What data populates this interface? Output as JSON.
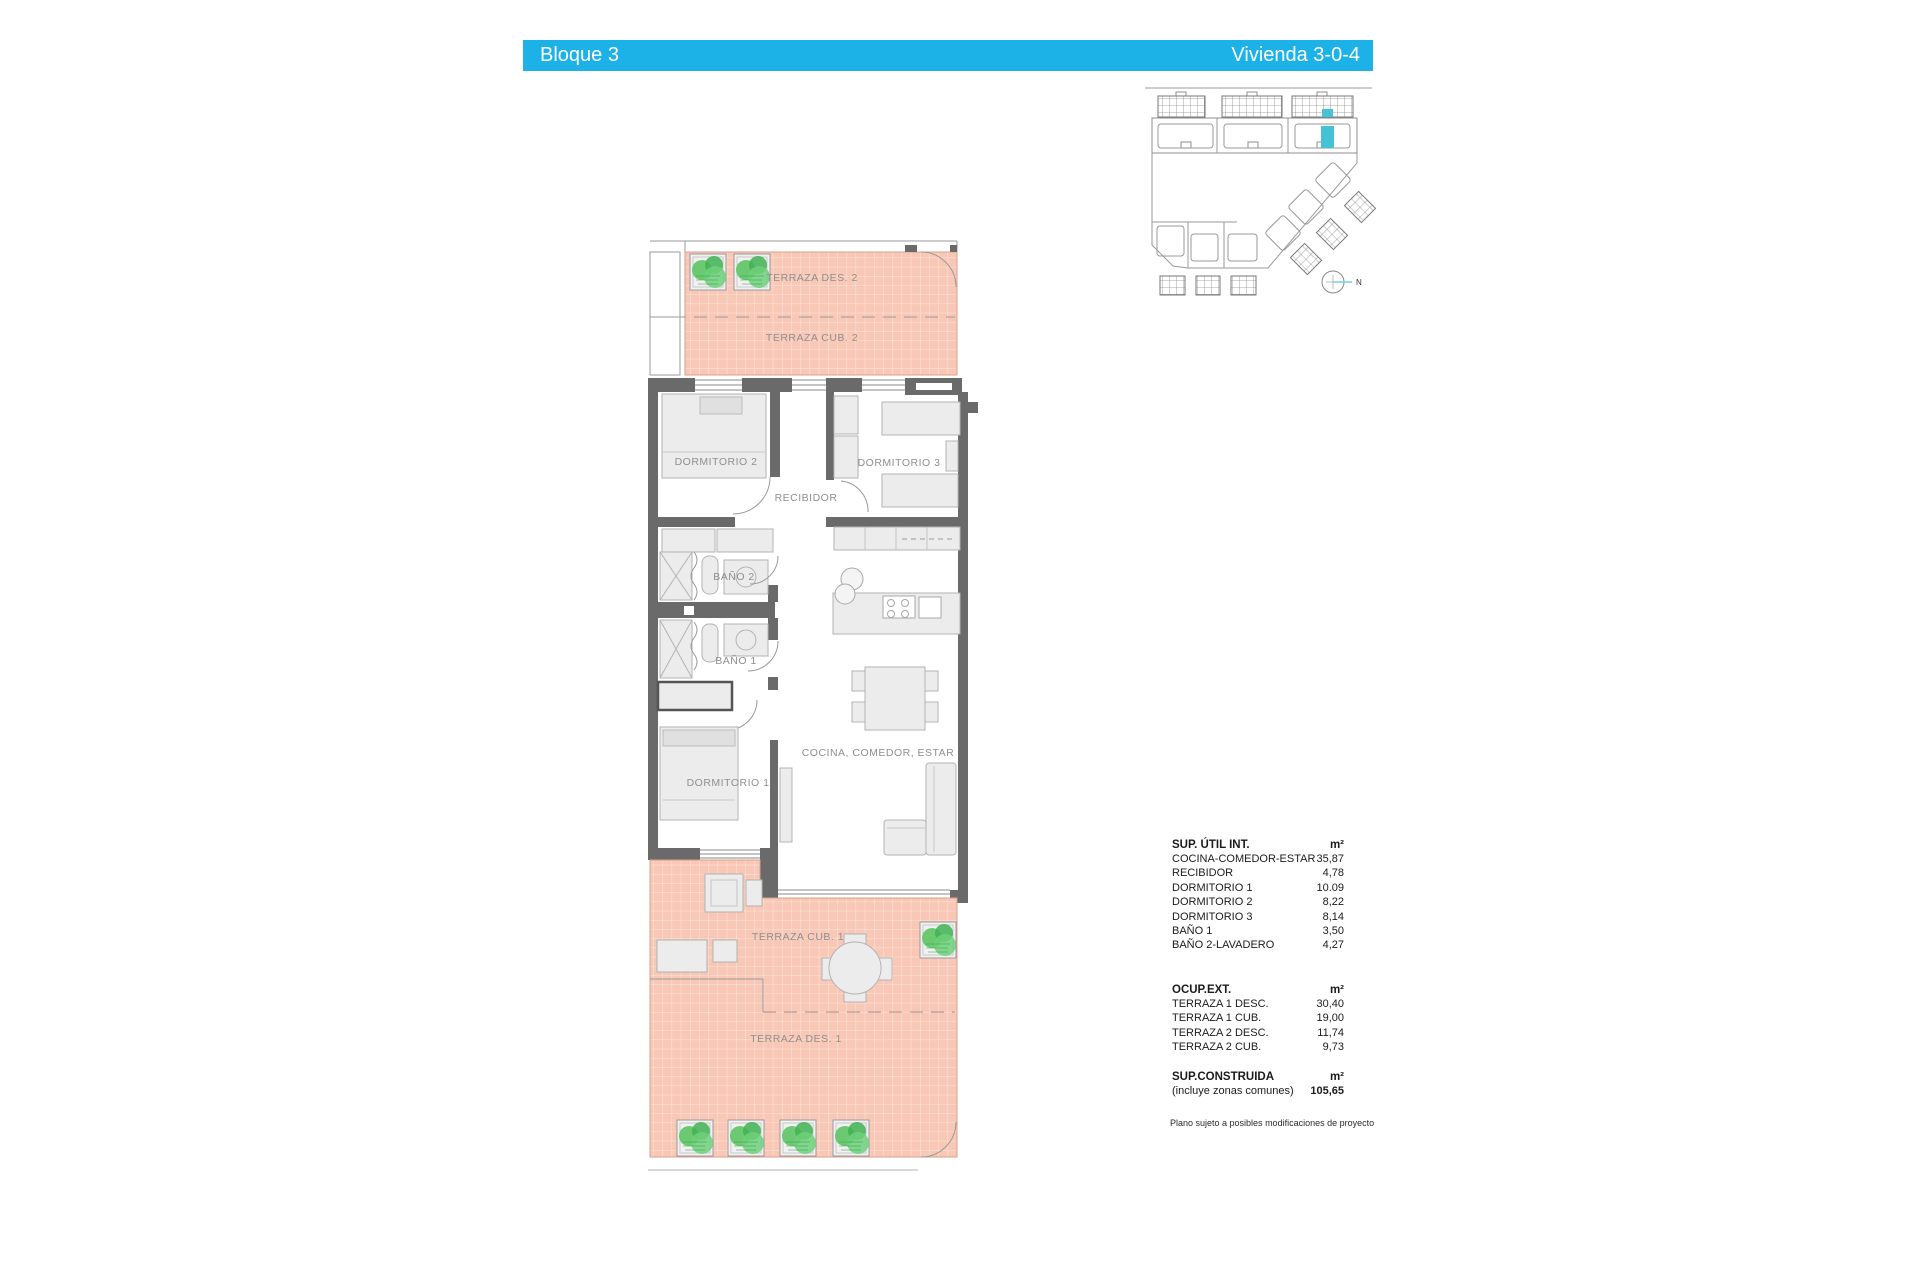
{
  "header": {
    "left_title": "Bloque 3",
    "right_title": "Vivienda 3-0-4",
    "bar_color": "#1cb2e8",
    "text_color": "#ffffff"
  },
  "site_plan": {
    "north_label": "N",
    "highlight_color": "#45c1d8"
  },
  "floor_plan": {
    "terrace_tile_color": "#f9c7b5",
    "plant_color": "#5cc463",
    "labels": {
      "terraza_des_2": "TERRAZA DES. 2",
      "terraza_cub_2": "TERRAZA CUB. 2",
      "dormitorio_2": "DORMITORIO 2",
      "dormitorio_3": "DORMITORIO 3",
      "recibidor": "RECIBIDOR",
      "bano_2": "BAÑO 2",
      "bano_1": "BAÑO 1",
      "dormitorio_1": "DORMITORIO 1",
      "cocina_comedor_estar": "COCINA, COMEDOR, ESTAR",
      "terraza_cub_1": "TERRAZA CUB. 1",
      "terraza_des_1": "TERRAZA DES. 1"
    }
  },
  "tables": {
    "sup_util": {
      "title": "SUP. ÚTIL INT.",
      "unit": "m²",
      "rows": [
        [
          "COCINA-COMEDOR-ESTAR",
          "35,87"
        ],
        [
          "RECIBIDOR",
          "4,78"
        ],
        [
          "DORMITORIO 1",
          "10.09"
        ],
        [
          "DORMITORIO 2",
          "8,22"
        ],
        [
          "DORMITORIO 3",
          "8,14"
        ],
        [
          "BAÑO 1",
          "3,50"
        ],
        [
          "BAÑO 2-LAVADERO",
          "4,27"
        ]
      ]
    },
    "ocup_ext": {
      "title": "OCUP.EXT.",
      "unit": "m²",
      "rows": [
        [
          "TERRAZA 1 DESC.",
          "30,40"
        ],
        [
          "TERRAZA 1 CUB.",
          "19,00"
        ],
        [
          "TERRAZA 2 DESC.",
          "11,74"
        ],
        [
          "TERRAZA 2 CUB.",
          "9,73"
        ]
      ]
    },
    "sup_construida": {
      "title": "SUP.CONSTRUIDA",
      "unit": "m²",
      "note": "(incluye zonas comunes)",
      "value": "105,65"
    },
    "disclaimer": "Plano sujeto a posibles modificaciones de proyecto"
  }
}
